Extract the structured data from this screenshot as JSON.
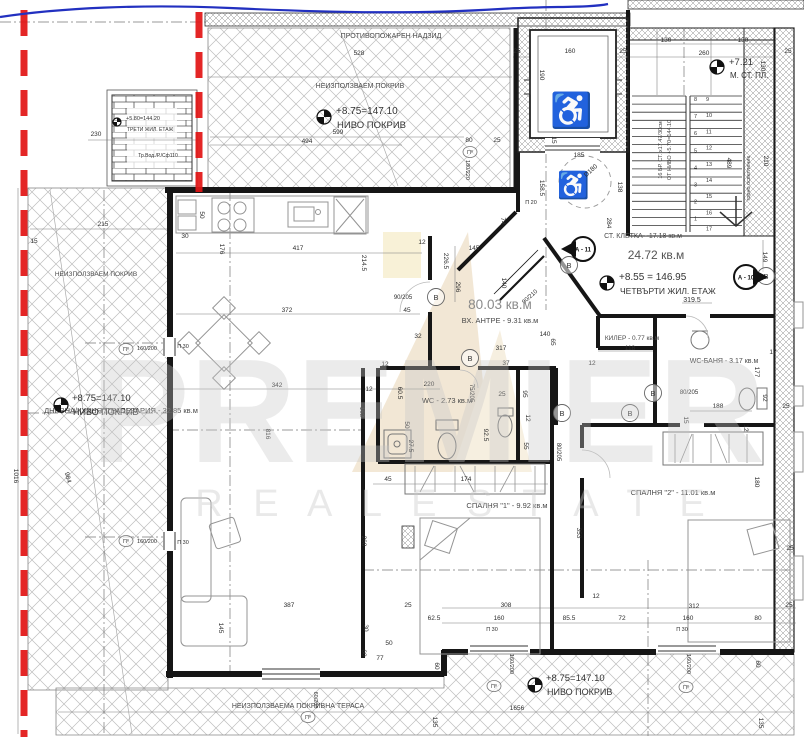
{
  "drawing": {
    "fire_wall_label": "ПРОТИВОПОЖАРЕН НАДЗИД",
    "area_labels": [
      {
        "label": "НЕИЗПОЛЗВАЕМ ПОКРИВ",
        "x": 360,
        "y": 88,
        "s": 7
      },
      {
        "label": "НЕИЗПОЛЗВАЕМ ПОКРИВ",
        "x": 96,
        "y": 276,
        "s": 6.5
      },
      {
        "label": "НЕИЗПОЛЗВАЕМА ПОКРИВНА ТЕРАСА",
        "x": 298,
        "y": 708,
        "s": 7
      }
    ],
    "colors": {
      "red_boundary": "#e21414",
      "blue_line": "#2230c0",
      "wall": "#161616",
      "hatch": "#b5b5b5",
      "watermark_gray": "#c7c7c7",
      "logo_tan": "#dcbd8a"
    }
  },
  "apartment": {
    "total_area": "80.03 кв.м",
    "entry": "ВХ. АНТРЕ - 9.31 кв.м",
    "rooms": [
      {
        "label": "ДНЕВНА/КУХНЯ /ТРАПЕЗАРИЯ - 32.85 кв.м",
        "x": 121,
        "y": 413,
        "s": 7.5
      },
      {
        "label": "WC - 2.73 кв.м",
        "x": 447,
        "y": 403,
        "s": 7.5
      },
      {
        "label": "СПАЛНЯ \"1\" - 9.92 кв.м",
        "x": 507,
        "y": 508,
        "s": 7.5
      },
      {
        "label": "СПАЛНЯ \"2\" - 11.01 кв.м",
        "x": 673,
        "y": 495,
        "s": 7.5
      },
      {
        "label": "WC-БАНЯ - 3.17 кв.м",
        "x": 724,
        "y": 363,
        "s": 7
      },
      {
        "label": "КИЛЕР - 0.77 кв.м",
        "x": 632,
        "y": 340,
        "s": 6.5
      },
      {
        "label": "СТ. КЛЕТКА - 17.18 кв.м",
        "x": 643,
        "y": 238,
        "s": 7
      }
    ]
  },
  "stairwell": {
    "area_big": "24.72 кв.м",
    "width_dim": "319.5",
    "left_numbers": [
      "8",
      "7",
      "6",
      "5",
      "4",
      "3",
      "2",
      "1"
    ],
    "right_numbers": [
      "9",
      "10",
      "11",
      "12",
      "13",
      "14",
      "15",
      "16",
      "17"
    ],
    "notes": [
      {
        "t": "16 БР. СТ. х17.47/30см",
        "x": 662,
        "y": 150,
        "r": -90,
        "s": 5.5
      },
      {
        "t": "ОТ НИВО +5.70=144.10",
        "x": 671,
        "y": 150,
        "r": -90,
        "s": 5.5
      },
      {
        "t": "горно осветление",
        "x": 750,
        "y": 178,
        "r": -90,
        "s": 5.5
      }
    ]
  },
  "levels": [
    {
      "v": "+8.75=147.10",
      "n": "НИВО ПОКРИВ",
      "x": 336,
      "y": 114,
      "ny": 128,
      "fx": 324,
      "fy": 117,
      "s": 10,
      "ns": 9.5
    },
    {
      "v": "+8.75=147.10",
      "n": "НИВО ПОКРИВ",
      "x": 72,
      "y": 401,
      "ny": 415,
      "fx": 61,
      "fy": 405,
      "s": 9.5,
      "ns": 9
    },
    {
      "v": "+8.75=147.10",
      "n": "НИВО ПОКРИВ",
      "x": 546,
      "y": 681,
      "ny": 695,
      "fx": 535,
      "fy": 685,
      "s": 9.5,
      "ns": 9
    },
    {
      "v": "+8.55 = 146.95",
      "n": "ЧЕТВЪРТИ ЖИЛ. ЕТАЖ",
      "x": 619,
      "y": 280,
      "ny": 294,
      "fx": 607,
      "fy": 283,
      "s": 10,
      "ns": 8.5
    },
    {
      "v": "+7.21",
      "n": "М. СТ. ПЛ.",
      "x": 729,
      "y": 65,
      "ny": 78,
      "fx": 717,
      "fy": 67,
      "s": 9.5,
      "ns": 8
    },
    {
      "v": "+5.80=144.20",
      "n": "ТРЕТИ ЖИЛ. ЕТАЖ",
      "x": 126,
      "y": 120,
      "ny": 131,
      "fx": 117,
      "fy": 122,
      "s": 5.5,
      "ns": 5
    }
  ],
  "misc_texts": [
    {
      "t": "24.72 кв.м",
      "x": 656,
      "y": 259,
      "s": 12,
      "c": "#555555"
    },
    {
      "t": "319.5",
      "x": 692,
      "y": 302,
      "s": 7
    },
    {
      "t": "Тр.Вод./Р./Сф110",
      "x": 158,
      "y": 157,
      "s": 5
    }
  ],
  "window_markers": [
    {
      "x": 126,
      "y": 349
    },
    {
      "x": 126,
      "y": 541
    },
    {
      "x": 470,
      "y": 152
    },
    {
      "x": 494,
      "y": 686
    },
    {
      "x": 686,
      "y": 687
    },
    {
      "x": 308,
      "y": 717
    }
  ],
  "window_marker_label": "Пº",
  "b_markers": [
    {
      "x": 436,
      "y": 297
    },
    {
      "x": 470,
      "y": 358
    },
    {
      "x": 562,
      "y": 413
    },
    {
      "x": 630,
      "y": 413
    },
    {
      "x": 653,
      "y": 393
    },
    {
      "x": 569,
      "y": 265
    },
    {
      "x": 766,
      "y": 276
    }
  ],
  "b_marker_label": "В",
  "section_markers": [
    {
      "label": "А - 10",
      "x": 746,
      "y": 277,
      "dir": "right"
    },
    {
      "label": "А - 11",
      "x": 583,
      "y": 249,
      "dir": "left"
    }
  ],
  "icons": {
    "wheelchair": "♿"
  },
  "watermark": {
    "line1": "PREMIER",
    "line2": "R E A L   E S T A T E"
  },
  "dimensions": [
    {
      "t": "528",
      "x": 359,
      "y": 55
    },
    {
      "t": "599",
      "x": 338,
      "y": 134
    },
    {
      "t": "494",
      "x": 307,
      "y": 143
    },
    {
      "t": "80",
      "x": 469,
      "y": 142
    },
    {
      "t": "25",
      "x": 497,
      "y": 142
    },
    {
      "t": "230",
      "x": 96,
      "y": 136
    },
    {
      "t": "160",
      "x": 570,
      "y": 53
    },
    {
      "t": "25",
      "x": 517,
      "y": 53
    },
    {
      "t": "25",
      "x": 623,
      "y": 53
    },
    {
      "t": "130",
      "x": 666,
      "y": 42
    },
    {
      "t": "130",
      "x": 743,
      "y": 42
    },
    {
      "t": "260",
      "x": 704,
      "y": 55
    },
    {
      "t": "25",
      "x": 788,
      "y": 53
    },
    {
      "t": "130",
      "x": 761,
      "y": 66,
      "r": 90
    },
    {
      "t": "190",
      "x": 540,
      "y": 75,
      "r": 90
    },
    {
      "t": "15",
      "x": 552,
      "y": 140,
      "r": 90
    },
    {
      "t": "185",
      "x": 579,
      "y": 157
    },
    {
      "t": "158.5",
      "x": 540,
      "y": 188,
      "r": 90
    },
    {
      "t": "138",
      "x": 618,
      "y": 187,
      "r": 90
    },
    {
      "t": "D180",
      "x": 592,
      "y": 172,
      "r": -42
    },
    {
      "t": "П 20",
      "x": 531,
      "y": 204,
      "s": 5.5
    },
    {
      "t": "489",
      "x": 727,
      "y": 163,
      "r": 90
    },
    {
      "t": "210",
      "x": 764,
      "y": 161,
      "r": 90
    },
    {
      "t": "284",
      "x": 607,
      "y": 223,
      "r": 90
    },
    {
      "t": "149",
      "x": 763,
      "y": 257,
      "r": 90
    },
    {
      "t": "74",
      "x": 501,
      "y": 221,
      "r": 90
    },
    {
      "t": "145",
      "x": 474,
      "y": 250
    },
    {
      "t": "12",
      "x": 422,
      "y": 244
    },
    {
      "t": "226.5",
      "x": 444,
      "y": 261,
      "r": 90
    },
    {
      "t": "296",
      "x": 456,
      "y": 287,
      "r": 90
    },
    {
      "t": "214.5",
      "x": 362,
      "y": 263,
      "r": 90
    },
    {
      "t": "417",
      "x": 298,
      "y": 250
    },
    {
      "t": "176",
      "x": 220,
      "y": 249,
      "r": 90
    },
    {
      "t": "50",
      "x": 200,
      "y": 215,
      "r": 90
    },
    {
      "t": "30",
      "x": 185,
      "y": 238
    },
    {
      "t": "215",
      "x": 103,
      "y": 226
    },
    {
      "t": "15",
      "x": 34,
      "y": 243
    },
    {
      "t": "372",
      "x": 287,
      "y": 312
    },
    {
      "t": "90/205",
      "x": 403,
      "y": 299,
      "s": 6
    },
    {
      "t": "45",
      "x": 407,
      "y": 312
    },
    {
      "t": "140",
      "x": 502,
      "y": 283,
      "r": 90
    },
    {
      "t": "32",
      "x": 418,
      "y": 338
    },
    {
      "t": "317",
      "x": 501,
      "y": 350
    },
    {
      "t": "37",
      "x": 506,
      "y": 365
    },
    {
      "t": "140",
      "x": 545,
      "y": 336
    },
    {
      "t": "65",
      "x": 551,
      "y": 342,
      "r": 90
    },
    {
      "t": "90/210",
      "x": 531,
      "y": 298,
      "r": -42,
      "s": 6
    },
    {
      "t": "118",
      "x": 630,
      "y": 350
    },
    {
      "t": "12",
      "x": 592,
      "y": 365
    },
    {
      "t": "17",
      "x": 773,
      "y": 354
    },
    {
      "t": "177",
      "x": 755,
      "y": 372,
      "r": 90
    },
    {
      "t": "92",
      "x": 763,
      "y": 398,
      "r": 90
    },
    {
      "t": "25",
      "x": 786,
      "y": 408
    },
    {
      "t": "188",
      "x": 718,
      "y": 408
    },
    {
      "t": "15",
      "x": 684,
      "y": 420,
      "r": 90
    },
    {
      "t": "12",
      "x": 744,
      "y": 428,
      "r": 90
    },
    {
      "t": "80/205",
      "x": 689,
      "y": 394,
      "s": 6
    },
    {
      "t": "180",
      "x": 755,
      "y": 482,
      "r": 90
    },
    {
      "t": "25",
      "x": 790,
      "y": 550
    },
    {
      "t": "353",
      "x": 577,
      "y": 533,
      "r": 90
    },
    {
      "t": "342",
      "x": 277,
      "y": 387
    },
    {
      "t": "816",
      "x": 266,
      "y": 434,
      "r": 90
    },
    {
      "t": "220",
      "x": 429,
      "y": 386
    },
    {
      "t": "12",
      "x": 385,
      "y": 366
    },
    {
      "t": "12",
      "x": 369,
      "y": 391
    },
    {
      "t": "60.5",
      "x": 398,
      "y": 393,
      "r": 90
    },
    {
      "t": "162",
      "x": 360,
      "y": 412,
      "r": 90
    },
    {
      "t": "50",
      "x": 405,
      "y": 425,
      "r": 90
    },
    {
      "t": "27.5",
      "x": 409,
      "y": 446,
      "r": 90
    },
    {
      "t": "25",
      "x": 502,
      "y": 396
    },
    {
      "t": "92.5",
      "x": 484,
      "y": 435,
      "r": 90
    },
    {
      "t": "95",
      "x": 523,
      "y": 394,
      "r": 90
    },
    {
      "t": "12",
      "x": 526,
      "y": 418,
      "r": 90
    },
    {
      "t": "55",
      "x": 524,
      "y": 446,
      "r": 90
    },
    {
      "t": "75/205",
      "x": 470,
      "y": 393,
      "r": 90,
      "s": 6
    },
    {
      "t": "80/205",
      "x": 557,
      "y": 452,
      "r": 90,
      "s": 6
    },
    {
      "t": "45",
      "x": 388,
      "y": 481
    },
    {
      "t": "174",
      "x": 466,
      "y": 481
    },
    {
      "t": "268",
      "x": 362,
      "y": 541,
      "r": 90
    },
    {
      "t": "12",
      "x": 596,
      "y": 598
    },
    {
      "t": "387",
      "x": 289,
      "y": 607
    },
    {
      "t": "145",
      "x": 219,
      "y": 628,
      "r": 90
    },
    {
      "t": "25",
      "x": 408,
      "y": 607
    },
    {
      "t": "62.5",
      "x": 434,
      "y": 620
    },
    {
      "t": "30",
      "x": 364,
      "y": 628,
      "r": 90
    },
    {
      "t": "50",
      "x": 389,
      "y": 645
    },
    {
      "t": "77",
      "x": 380,
      "y": 660
    },
    {
      "t": "60",
      "x": 362,
      "y": 653,
      "r": 90
    },
    {
      "t": "60",
      "x": 435,
      "y": 666,
      "r": 90
    },
    {
      "t": "308",
      "x": 506,
      "y": 607
    },
    {
      "t": "160",
      "x": 499,
      "y": 620
    },
    {
      "t": "85.5",
      "x": 569,
      "y": 620
    },
    {
      "t": "72",
      "x": 622,
      "y": 620
    },
    {
      "t": "312",
      "x": 694,
      "y": 608
    },
    {
      "t": "160",
      "x": 688,
      "y": 620
    },
    {
      "t": "80",
      "x": 758,
      "y": 620
    },
    {
      "t": "25",
      "x": 789,
      "y": 607
    },
    {
      "t": "1656",
      "x": 517,
      "y": 710
    },
    {
      "t": "135",
      "x": 433,
      "y": 722,
      "r": 90
    },
    {
      "t": "135",
      "x": 759,
      "y": 723,
      "r": 90
    },
    {
      "t": "60",
      "x": 756,
      "y": 664,
      "r": 90
    },
    {
      "t": "П 30",
      "x": 492,
      "y": 631,
      "s": 5.5
    },
    {
      "t": "П 30",
      "x": 682,
      "y": 631,
      "s": 5.5
    },
    {
      "t": "П 30",
      "x": 183,
      "y": 348,
      "s": 5.5
    },
    {
      "t": "П 30",
      "x": 183,
      "y": 544,
      "s": 5.5
    },
    {
      "t": "160/200",
      "x": 147,
      "y": 350,
      "s": 5.5
    },
    {
      "t": "160/200",
      "x": 147,
      "y": 543,
      "s": 5.5
    },
    {
      "t": "180/220",
      "x": 466,
      "y": 170,
      "r": 90,
      "s": 5.5
    },
    {
      "t": "160/200",
      "x": 510,
      "y": 664,
      "r": 90,
      "s": 5.5
    },
    {
      "t": "160/200",
      "x": 687,
      "y": 664,
      "r": 90,
      "s": 5.5
    },
    {
      "t": "60/200",
      "x": 314,
      "y": 700,
      "r": 90,
      "s": 5.5
    },
    {
      "t": "1016",
      "x": 14,
      "y": 476,
      "r": 90
    },
    {
      "t": "984",
      "x": 66,
      "y": 478,
      "r": 75
    }
  ]
}
